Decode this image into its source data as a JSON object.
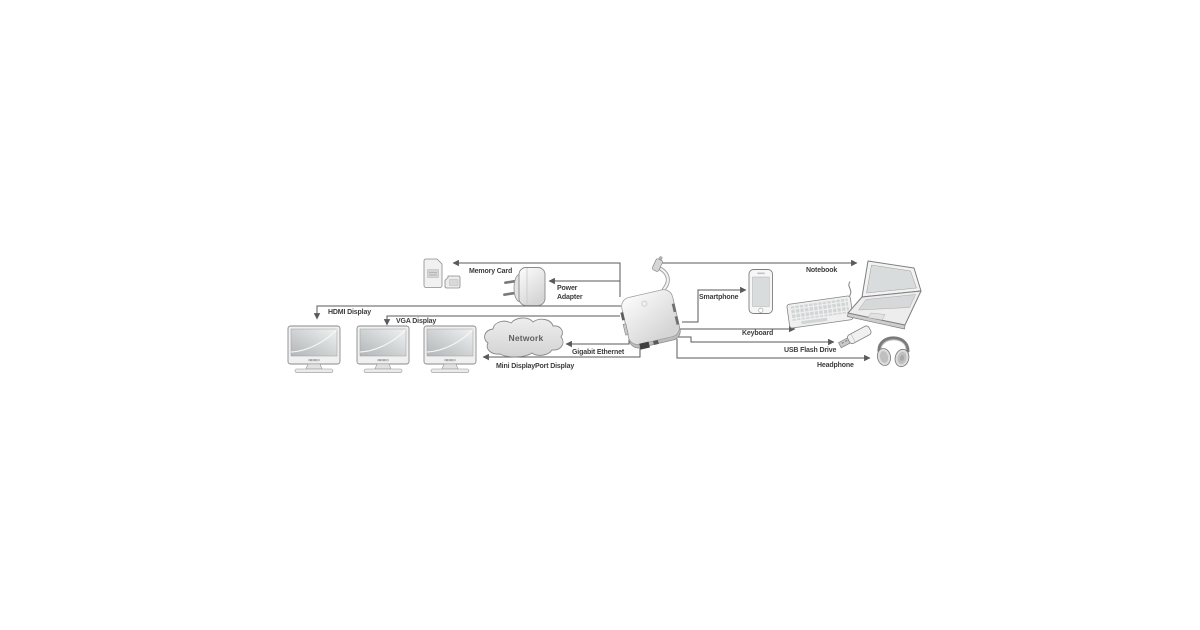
{
  "diagram": {
    "type": "connectivity-diagram",
    "labels": {
      "memory_card": "Memory Card",
      "power_line1": "Power",
      "power_line2": "Adapter",
      "notebook": "Notebook",
      "smartphone": "Smartphone",
      "keyboard": "Keyboard",
      "usb_flash_drive": "USB Flash Drive",
      "headphone": "Headphone",
      "hdmi_display": "HDMI Display",
      "vga_display": "VGA Display",
      "network": "Network",
      "gigabit_ethernet": "Gigabit Ethernet",
      "mini_displayport_display": "Mini DisplayPort Display"
    },
    "connections": [
      {
        "from": "dock",
        "to": "memory-card",
        "label": "Memory Card"
      },
      {
        "from": "dock",
        "to": "power-adapter",
        "label": "Power Adapter"
      },
      {
        "from": "dock",
        "to": "notebook",
        "label": "Notebook"
      },
      {
        "from": "dock",
        "to": "smartphone",
        "label": "Smartphone"
      },
      {
        "from": "dock",
        "to": "keyboard",
        "label": "Keyboard"
      },
      {
        "from": "dock",
        "to": "usb-flash-drive",
        "label": "USB Flash Drive"
      },
      {
        "from": "dock",
        "to": "headphone",
        "label": "Headphone"
      },
      {
        "from": "dock",
        "to": "monitor-1",
        "label": "HDMI Display"
      },
      {
        "from": "dock",
        "to": "monitor-2",
        "label": "VGA Display"
      },
      {
        "from": "dock",
        "to": "monitor-3",
        "label": "Mini DisplayPort Display"
      },
      {
        "from": "dock",
        "to": "network-cloud",
        "label": "Gigabit Ethernet"
      }
    ],
    "colors": {
      "background": "#ffffff",
      "line": "#5a5a5a",
      "text": "#3d3d3d",
      "outline": "#8a8a8a",
      "device_fill": "#ededed"
    }
  }
}
